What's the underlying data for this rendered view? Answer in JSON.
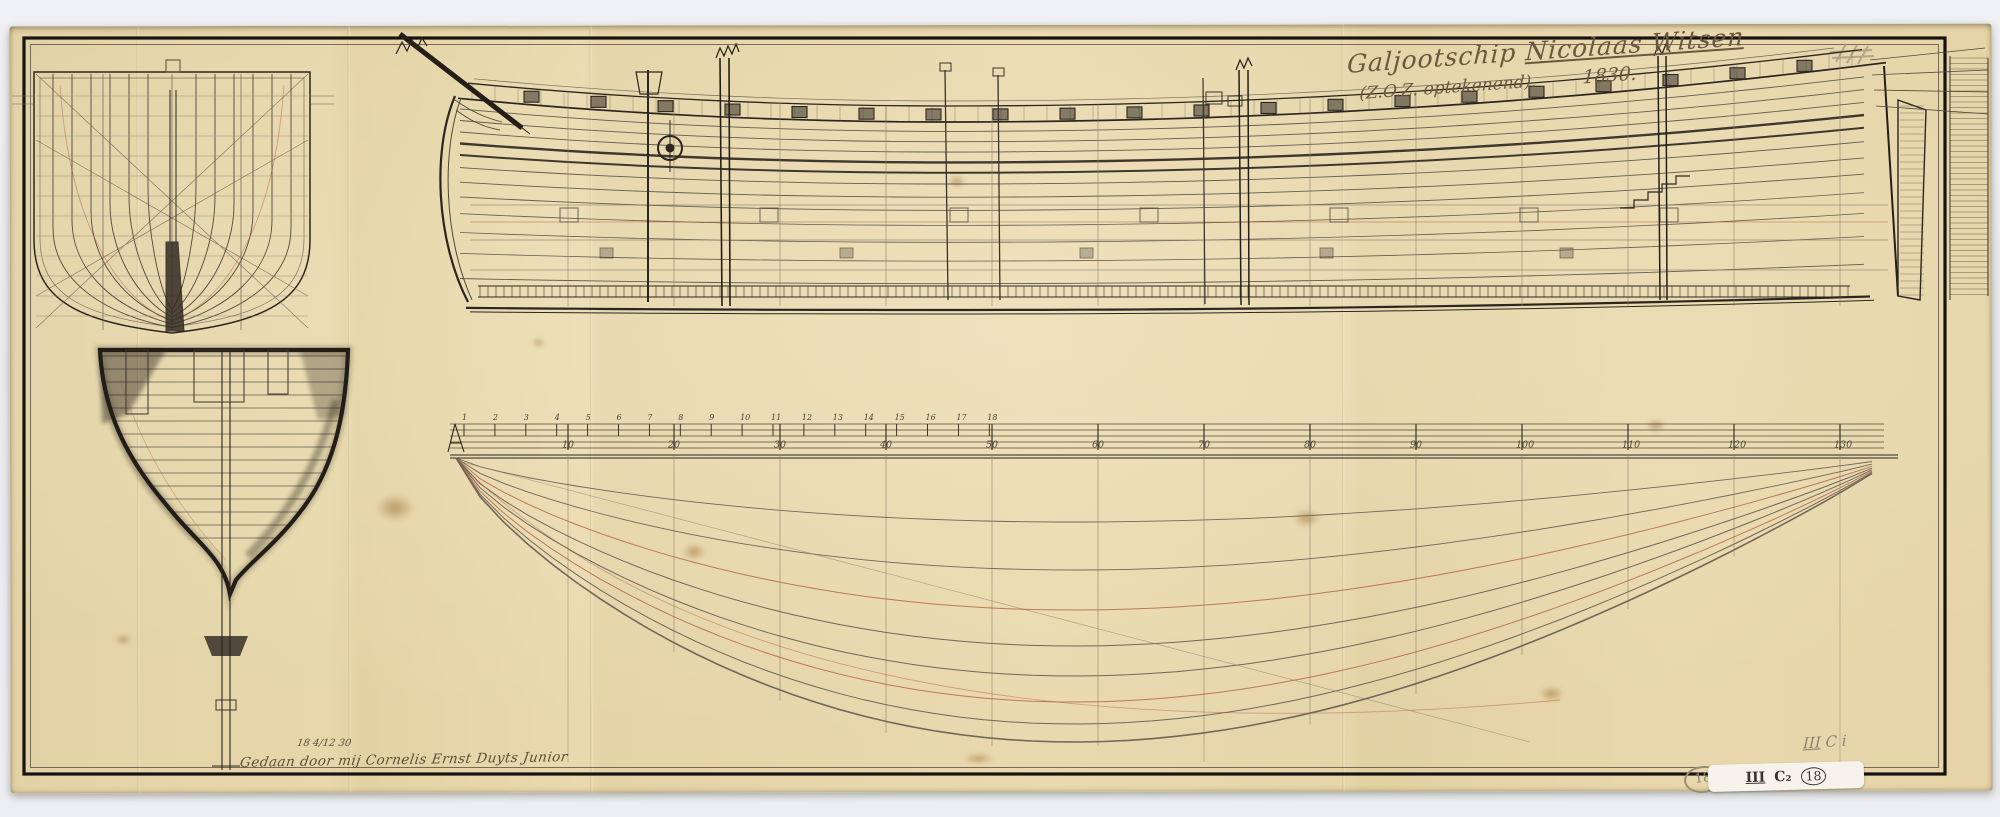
{
  "annotations": {
    "title_prefix": "Galjootschip",
    "title_name": "Nicolaas Witsen",
    "title_line2": "(Z.O.Z. optekenend).",
    "title_year": "1830.",
    "signature_date": "18 4/12 30",
    "signature": "Gedaan door mij Cornelis Ernst Duyts Junior",
    "shelfmark_series": "III",
    "shelfmark_rest": "C i",
    "label_left_circle": "18",
    "label_series": "III",
    "label_class": "C₂",
    "label_number": "18"
  },
  "scale_bar": {
    "fine_numbers": [
      "1",
      "2",
      "3",
      "4",
      "5",
      "6",
      "7",
      "8",
      "9",
      "10",
      "11",
      "12",
      "13",
      "14",
      "15",
      "16",
      "17",
      "18"
    ],
    "coarse_numbers": [
      "10",
      "20",
      "30",
      "40",
      "50",
      "60",
      "70",
      "80",
      "90",
      "100",
      "110",
      "120",
      "130"
    ]
  },
  "colors": {
    "paper": "#e6d5a9",
    "background": "#e9ebee",
    "ink": "#2b2620",
    "graphite": "#564e42",
    "red_ink": "#b0563d",
    "pencil": "#958a76",
    "handwriting_ink": "#6b573f",
    "label_background": "#f5f3ec"
  }
}
